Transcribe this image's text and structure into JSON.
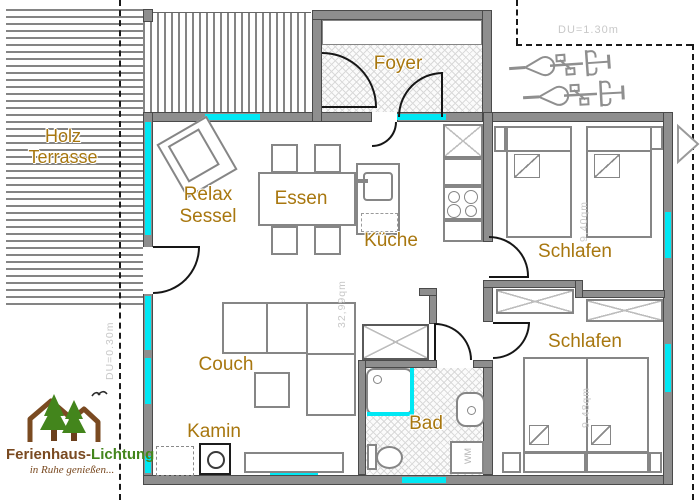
{
  "plan_labels": {
    "terrace_line1": "Holz",
    "terrace_line2": "Terrasse",
    "foyer": "Foyer",
    "relax_line1": "Relax",
    "relax_line2": "Sessel",
    "dining": "Essen",
    "kitchen": "Küche",
    "bedroom1": "Schlafen",
    "bedroom2": "Schlafen",
    "couch": "Couch",
    "fireplace": "Kamin",
    "bath": "Bad",
    "washing_machine": "WM"
  },
  "room_areas": {
    "living": "32,99qm",
    "bedroom1": "9,40qm",
    "bedroom2": "9,48qm"
  },
  "dimension_notes": {
    "top": "DU=1.30m",
    "left": "DU=0.30m"
  },
  "logo": {
    "brand_part1": "Ferienhaus-",
    "brand_part2": "Lichtung",
    "tagline": "in Ruhe genießen..."
  },
  "colors": {
    "wall_gray": "#8e8e8e",
    "window_cyan": "#00e8f4",
    "room_label_orange": "#a8770f",
    "faint_text_gray": "#c8c8c8",
    "logo_brown": "#7a4a21",
    "logo_green": "#43851c"
  }
}
